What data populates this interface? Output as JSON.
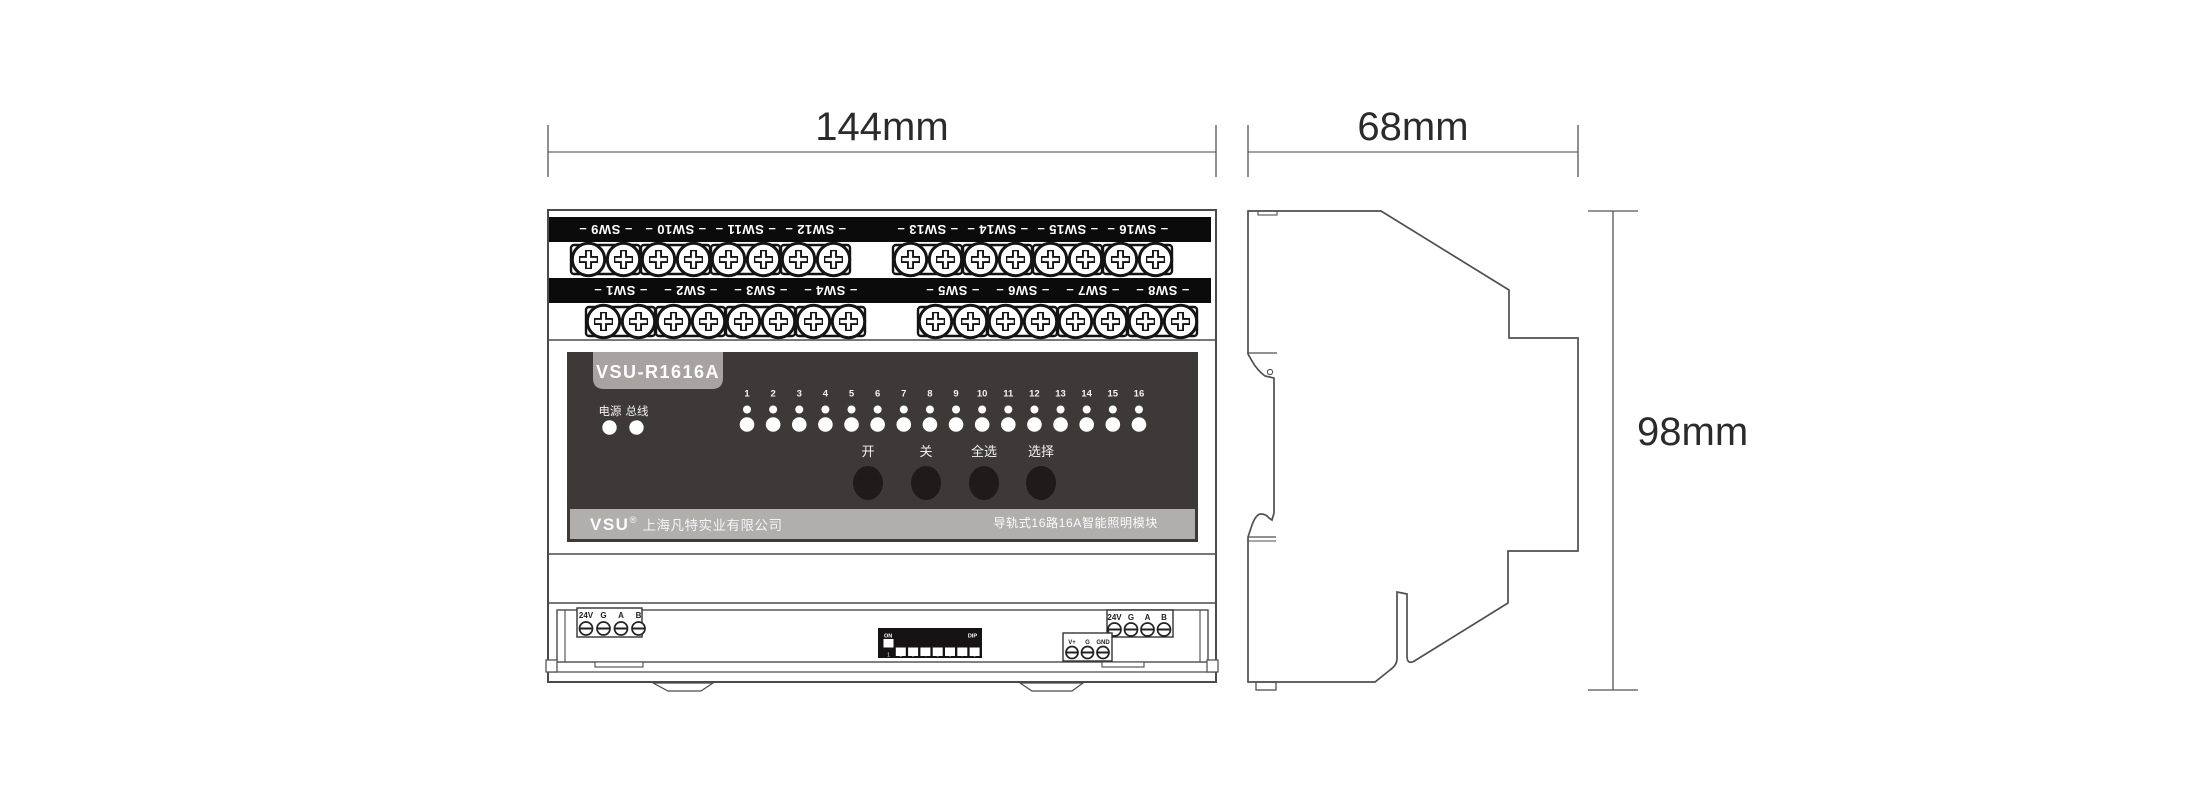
{
  "dimensions": {
    "front_width": "144mm",
    "side_width": "68mm",
    "height": "98mm"
  },
  "front_view": {
    "top_row_labels": [
      "SW9",
      "SW10",
      "SW11",
      "SW12",
      "SW13",
      "SW14",
      "SW15",
      "SW16"
    ],
    "bottom_row_labels": [
      "SW1",
      "SW2",
      "SW3",
      "SW4",
      "SW5",
      "SW6",
      "SW7",
      "SW8"
    ],
    "panel": {
      "model": "VSU-R1616A",
      "status_labels": [
        "电源",
        "总线"
      ],
      "channel_numbers": [
        "1",
        "2",
        "3",
        "4",
        "5",
        "6",
        "7",
        "8",
        "9",
        "10",
        "11",
        "12",
        "13",
        "14",
        "15",
        "16"
      ],
      "button_labels": [
        "开",
        "关",
        "全选",
        "选择"
      ],
      "brand": "VSU",
      "registered_mark": "®",
      "company": "上海凡特实业有限公司",
      "product_description": "导轨式16路16A智能照明模块"
    },
    "bottom_terminals": {
      "left_power_bus": [
        "24V",
        "G",
        "A",
        "B"
      ],
      "right_power_bus": [
        "24V",
        "G",
        "A",
        "B"
      ],
      "aux": [
        "V+",
        "G",
        "GND"
      ],
      "dip_switch": {
        "on_label": "ON",
        "dip_label": "DIP",
        "numbers": [
          "1",
          "2",
          "3",
          "4",
          "5",
          "6",
          "7",
          "8"
        ],
        "states": [
          "on",
          "off",
          "off",
          "off",
          "off",
          "off",
          "off",
          "off"
        ]
      }
    }
  },
  "colors": {
    "panel_dark": "#3d3939",
    "terminal_bar": "#0b0b0b",
    "label_bar_gray": "#b1aeae",
    "badge_gray": "#a7a3a3",
    "button_dark": "#1f1b1b",
    "line": "#4a4a4a",
    "led_white": "#ffffff"
  }
}
